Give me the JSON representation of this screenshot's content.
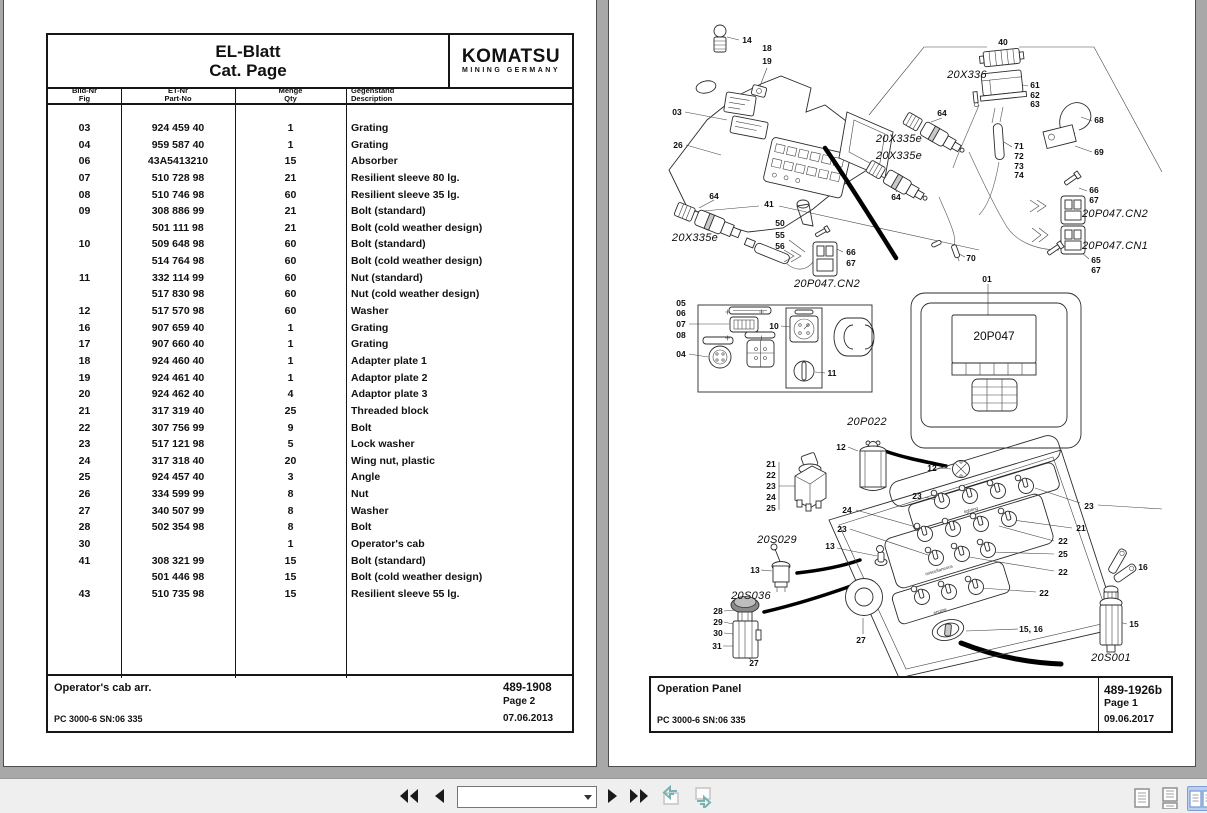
{
  "left_page": {
    "header": {
      "title_line1": "EL-Blatt",
      "title_line2": "Cat. Page",
      "brand": "KOMATSU",
      "brand_sub": "MINING GERMANY"
    },
    "columns": [
      {
        "de": "Bild-Nr",
        "en": "Fig"
      },
      {
        "de": "ET-Nr",
        "en": "Part-No"
      },
      {
        "de": "Menge",
        "en": "Qty"
      },
      {
        "de": "Gegenstand",
        "en": "Description"
      }
    ],
    "rows": [
      [
        "03",
        "924 459 40",
        "1",
        "Grating"
      ],
      [
        "04",
        "959 587 40",
        "1",
        "Grating"
      ],
      [
        "06",
        "43A5413210",
        "15",
        "Absorber"
      ],
      [
        "07",
        "510 728 98",
        "21",
        "Resilient sleeve 80 lg."
      ],
      [
        "08",
        "510 746 98",
        "60",
        "Resilient sleeve 35 lg."
      ],
      [
        "09",
        "308 886 99",
        "21",
        "Bolt (standard)"
      ],
      [
        "",
        "501 111 98",
        "21",
        "Bolt (cold weather design)"
      ],
      [
        "10",
        "509 648 98",
        "60",
        "Bolt (standard)"
      ],
      [
        "",
        "514 764 98",
        "60",
        "Bolt (cold weather design)"
      ],
      [
        "11",
        "332 114 99",
        "60",
        "Nut (standard)"
      ],
      [
        "",
        "517 830 98",
        "60",
        "Nut (cold weather design)"
      ],
      [
        "12",
        "517 570 98",
        "60",
        "Washer"
      ],
      [
        "16",
        "907 659 40",
        "1",
        "Grating"
      ],
      [
        "17",
        "907 660 40",
        "1",
        "Grating"
      ],
      [
        "18",
        "924 460 40",
        "1",
        "Adapter plate 1"
      ],
      [
        "19",
        "924 461 40",
        "1",
        "Adaptor plate 2"
      ],
      [
        "20",
        "924 462 40",
        "4",
        "Adaptor plate 3"
      ],
      [
        "21",
        "317 319 40",
        "25",
        "Threaded block"
      ],
      [
        "22",
        "307 756 99",
        "9",
        "Bolt"
      ],
      [
        "23",
        "517 121 98",
        "5",
        "Lock washer"
      ],
      [
        "24",
        "317 318 40",
        "20",
        "Wing nut, plastic"
      ],
      [
        "25",
        "924 457 40",
        "3",
        "Angle"
      ],
      [
        "26",
        "334 599 99",
        "8",
        "Nut"
      ],
      [
        "27",
        "340 507 99",
        "8",
        "Washer"
      ],
      [
        "28",
        "502 354 98",
        "8",
        "Bolt"
      ],
      [
        "30",
        "",
        "1",
        "Operator's cab"
      ],
      [
        "41",
        "308 321 99",
        "15",
        "Bolt (standard)"
      ],
      [
        "",
        "501 446 98",
        "15",
        "Bolt (cold weather design)"
      ],
      [
        "43",
        "510 735 98",
        "15",
        "Resilient sleeve 55 lg."
      ]
    ],
    "footer": {
      "arrangement": "Operator's cab arr.",
      "doc_no": "489-1908",
      "page": "Page 2",
      "machine": "PC 3000-6 SN:06 335",
      "date": "07.06.2013"
    }
  },
  "right_page": {
    "footer": {
      "title": "Operation Panel",
      "doc_no": "489-1926b",
      "page": "Page 1",
      "machine": "PC 3000-6 SN:06 335",
      "date": "09.06.2017"
    },
    "labels": [
      {
        "t": "14",
        "x": 138,
        "y": 40
      },
      {
        "t": "18",
        "x": 158,
        "y": 48
      },
      {
        "t": "19",
        "x": 158,
        "y": 61
      },
      {
        "t": "03",
        "x": 68,
        "y": 112
      },
      {
        "t": "26",
        "x": 69,
        "y": 145
      },
      {
        "t": "64",
        "x": 105,
        "y": 196
      },
      {
        "t": "64",
        "x": 287,
        "y": 197
      },
      {
        "t": "64",
        "x": 333,
        "y": 113
      },
      {
        "t": "41",
        "x": 160,
        "y": 204
      },
      {
        "t": "50",
        "x": 171,
        "y": 223
      },
      {
        "t": "55",
        "x": 171,
        "y": 235
      },
      {
        "t": "56",
        "x": 171,
        "y": 246
      },
      {
        "t": "66",
        "x": 242,
        "y": 252
      },
      {
        "t": "67",
        "x": 242,
        "y": 263
      },
      {
        "t": "40",
        "x": 394,
        "y": 42
      },
      {
        "t": "61",
        "x": 426,
        "y": 85
      },
      {
        "t": "62",
        "x": 426,
        "y": 95
      },
      {
        "t": "63",
        "x": 426,
        "y": 104
      },
      {
        "t": "68",
        "x": 490,
        "y": 120
      },
      {
        "t": "69",
        "x": 490,
        "y": 152
      },
      {
        "t": "71",
        "x": 410,
        "y": 146
      },
      {
        "t": "72",
        "x": 410,
        "y": 156
      },
      {
        "t": "73",
        "x": 410,
        "y": 166
      },
      {
        "t": "74",
        "x": 410,
        "y": 175
      },
      {
        "t": "66",
        "x": 485,
        "y": 190
      },
      {
        "t": "67",
        "x": 485,
        "y": 200
      },
      {
        "t": "65",
        "x": 487,
        "y": 260
      },
      {
        "t": "67",
        "x": 487,
        "y": 270
      },
      {
        "t": "70",
        "x": 362,
        "y": 258
      },
      {
        "t": "01",
        "x": 378,
        "y": 279
      },
      {
        "t": "05",
        "x": 72,
        "y": 303
      },
      {
        "t": "06",
        "x": 72,
        "y": 313
      },
      {
        "t": "07",
        "x": 72,
        "y": 324
      },
      {
        "t": "08",
        "x": 72,
        "y": 335
      },
      {
        "t": "04",
        "x": 72,
        "y": 354
      },
      {
        "t": "10",
        "x": 165,
        "y": 326
      },
      {
        "t": "11",
        "x": 223,
        "y": 373
      },
      {
        "t": "12",
        "x": 232,
        "y": 447
      },
      {
        "t": "21",
        "x": 162,
        "y": 464
      },
      {
        "t": "22",
        "x": 162,
        "y": 475
      },
      {
        "t": "23",
        "x": 162,
        "y": 486
      },
      {
        "t": "24",
        "x": 162,
        "y": 497
      },
      {
        "t": "25",
        "x": 162,
        "y": 508
      },
      {
        "t": "24",
        "x": 238,
        "y": 510
      },
      {
        "t": "23",
        "x": 233,
        "y": 529
      },
      {
        "t": "13",
        "x": 221,
        "y": 546
      },
      {
        "t": "13",
        "x": 146,
        "y": 570
      },
      {
        "t": "12",
        "x": 323,
        "y": 468
      },
      {
        "t": "23",
        "x": 308,
        "y": 496
      },
      {
        "t": "23",
        "x": 480,
        "y": 506
      },
      {
        "t": "21",
        "x": 472,
        "y": 528
      },
      {
        "t": "22",
        "x": 454,
        "y": 541
      },
      {
        "t": "25",
        "x": 454,
        "y": 554
      },
      {
        "t": "22",
        "x": 454,
        "y": 572
      },
      {
        "t": "22",
        "x": 435,
        "y": 593
      },
      {
        "t": "15, 16",
        "x": 422,
        "y": 629
      },
      {
        "t": "27",
        "x": 252,
        "y": 640
      },
      {
        "t": "28",
        "x": 109,
        "y": 611
      },
      {
        "t": "29",
        "x": 109,
        "y": 622
      },
      {
        "t": "30",
        "x": 109,
        "y": 633
      },
      {
        "t": "31",
        "x": 108,
        "y": 646
      },
      {
        "t": "27",
        "x": 145,
        "y": 663
      },
      {
        "t": "16",
        "x": 534,
        "y": 567
      },
      {
        "t": "15",
        "x": 525,
        "y": 624
      },
      {
        "t": "20X336",
        "x": 358,
        "y": 75,
        "c": "t"
      },
      {
        "t": "20X335e",
        "x": 290,
        "y": 139,
        "c": "t"
      },
      {
        "t": "20X335e",
        "x": 290,
        "y": 156,
        "c": "t"
      },
      {
        "t": "20X335e",
        "x": 86,
        "y": 238,
        "c": "t"
      },
      {
        "t": "20P047.CN2",
        "x": 218,
        "y": 284,
        "c": "t"
      },
      {
        "t": "20P047.CN2",
        "x": 506,
        "y": 214,
        "c": "t"
      },
      {
        "t": "20P047.CN1",
        "x": 506,
        "y": 246,
        "c": "t"
      },
      {
        "t": "20P022",
        "x": 258,
        "y": 422,
        "c": "t"
      },
      {
        "t": "20S029",
        "x": 168,
        "y": 540,
        "c": "t"
      },
      {
        "t": "20S036",
        "x": 142,
        "y": 596,
        "c": "t"
      },
      {
        "t": "20S001",
        "x": 502,
        "y": 658,
        "c": "t"
      },
      {
        "t": "20P047",
        "x": 385,
        "y": 336,
        "c": "scr"
      },
      {
        "t": "lighting",
        "x": 362,
        "y": 510,
        "c": "s"
      },
      {
        "t": "miscellaneous",
        "x": 330,
        "y": 570,
        "c": "s"
      },
      {
        "t": "engine",
        "x": 331,
        "y": 611,
        "c": "s"
      }
    ]
  },
  "toolbar": {
    "page_field": "",
    "buttons": [
      {
        "name": "first-page",
        "icon": "double-left-triangle"
      },
      {
        "name": "previous-page",
        "icon": "left-triangle"
      },
      {
        "name": "next-page",
        "icon": "right-triangle"
      },
      {
        "name": "last-page",
        "icon": "double-right-triangle"
      }
    ],
    "window_buttons": [
      {
        "name": "copy-to-window",
        "icon": "window-arrow-in"
      },
      {
        "name": "send-to-window",
        "icon": "window-arrow-out"
      }
    ],
    "layout_buttons": [
      {
        "name": "single-page-view",
        "icon": "single-page"
      },
      {
        "name": "continuous-view",
        "icon": "stacked-pages"
      },
      {
        "name": "facing-pages-view",
        "icon": "two-pages",
        "selected": true
      }
    ]
  }
}
